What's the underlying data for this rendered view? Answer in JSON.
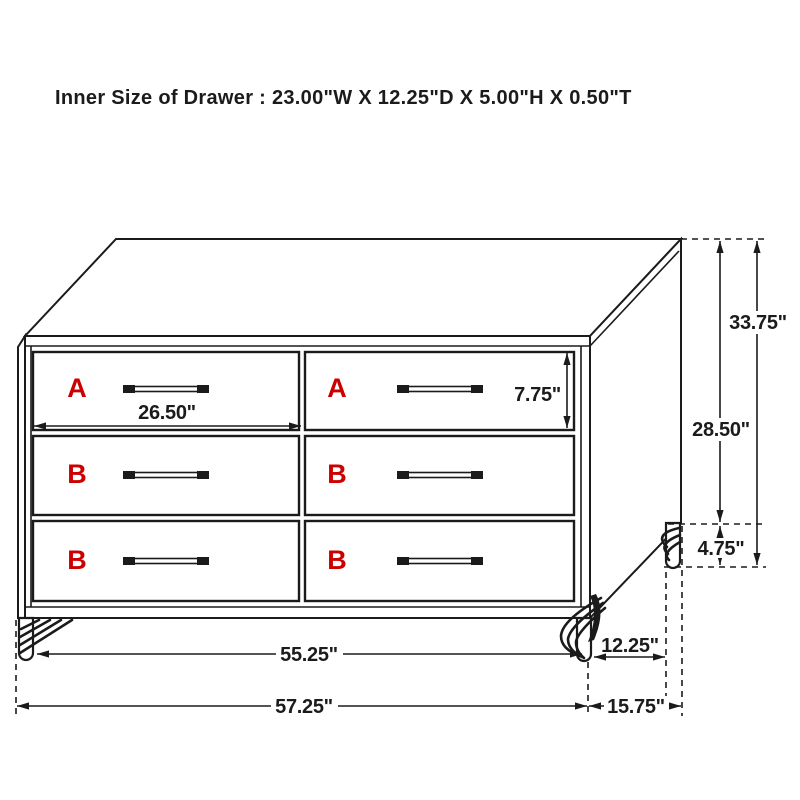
{
  "title": "Inner Size of Drawer : 23.00\"W X 12.25\"D X 5.00\"H X 0.50\"T",
  "colors": {
    "line": "#1b1b1b",
    "label_red": "#cc0000",
    "background": "#ffffff"
  },
  "drawers": {
    "labels": [
      "A",
      "A",
      "B",
      "B",
      "B",
      "B"
    ]
  },
  "dimensions": {
    "drawer_front_width": "26.50\"",
    "drawer_front_height": "7.75\"",
    "overall_height": "33.75\"",
    "body_height": "28.50\"",
    "leg_height": "4.75\"",
    "width_between_legs": "55.25\"",
    "leg_depth_spacing": "12.25\"",
    "overall_width": "57.25\"",
    "overall_depth": "15.75\""
  }
}
